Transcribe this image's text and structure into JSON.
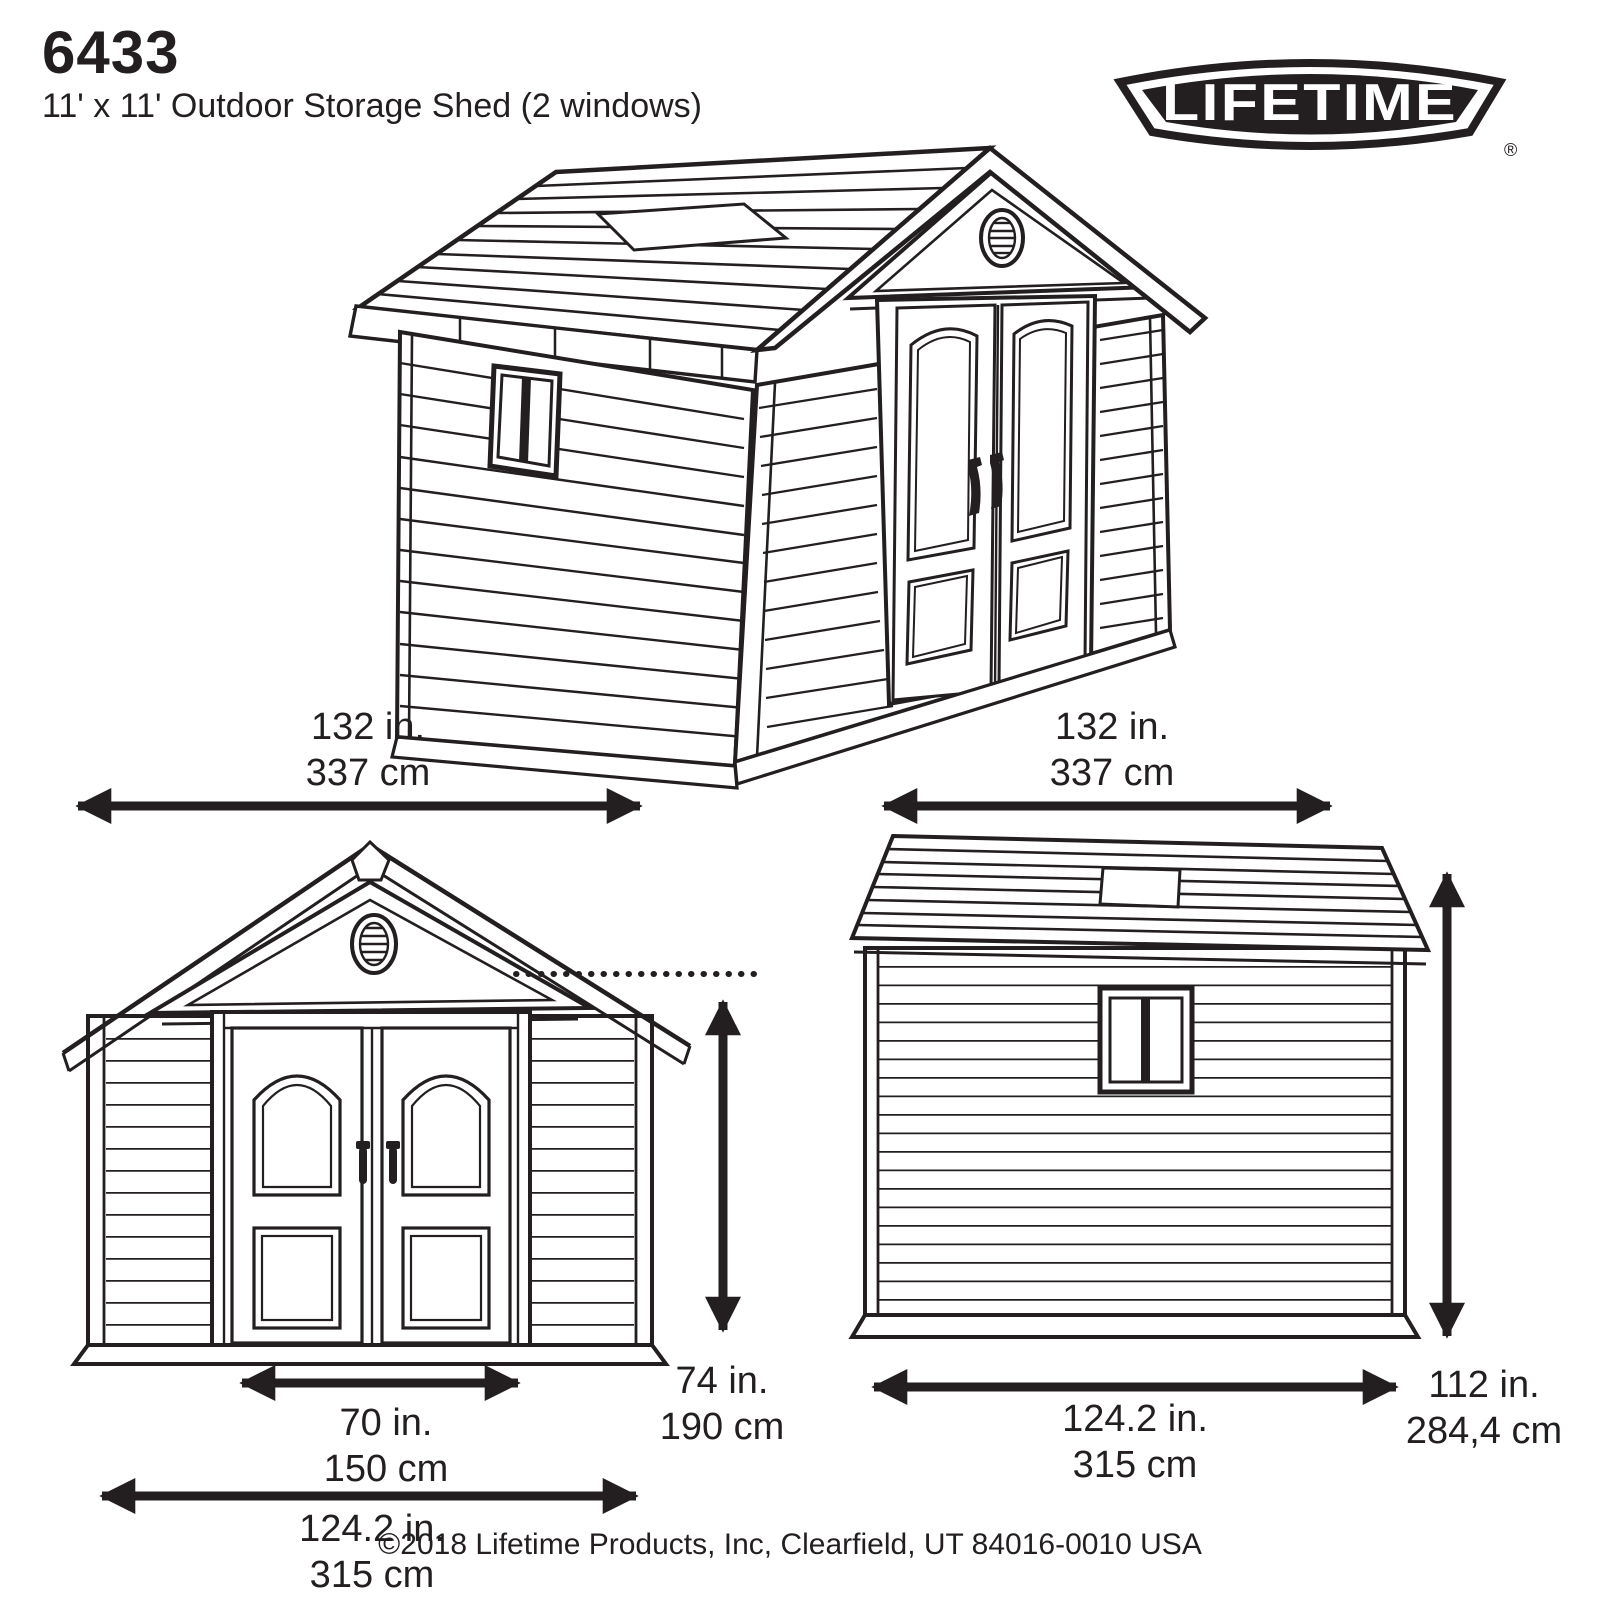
{
  "header": {
    "model": "6433",
    "subtitle": "11' x 11' Outdoor Storage Shed (2 windows)"
  },
  "logo": {
    "brand": "LIFETIME",
    "registered_mark": "®"
  },
  "dimensions": {
    "front_width": {
      "inches": "132 in.",
      "cm": "337 cm"
    },
    "side_width": {
      "inches": "132 in.",
      "cm": "337 cm"
    },
    "door_opening_width": {
      "inches": "70 in.",
      "cm": "150 cm"
    },
    "front_base_width": {
      "inches": "124.2 in.",
      "cm": "315 cm"
    },
    "wall_height": {
      "inches": "74 in.",
      "cm": "190 cm"
    },
    "side_base_depth": {
      "inches": "124.2 in.",
      "cm": "315 cm"
    },
    "overall_height": {
      "inches": "112 in.",
      "cm": "284,4 cm"
    }
  },
  "footer": {
    "copyright": "©2018 Lifetime Products, Inc, Clearfield, UT 84016-0010 USA"
  },
  "colors": {
    "ink": "#231f20",
    "background": "#ffffff"
  }
}
